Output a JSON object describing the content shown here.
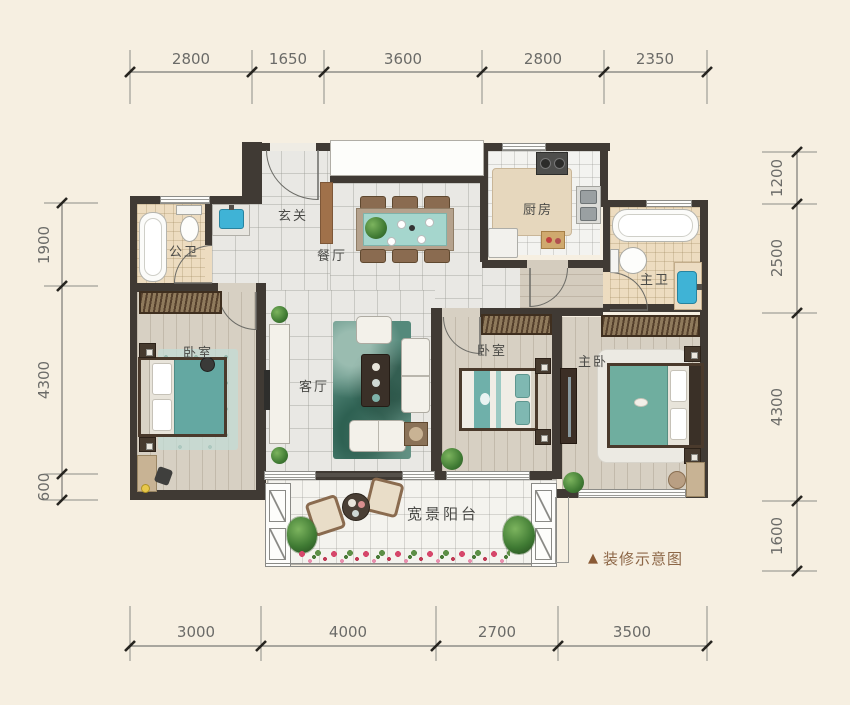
{
  "rooms": {
    "entry": "玄关",
    "guest_bath": "公卫",
    "dining": "餐厅",
    "kitchen": "厨房",
    "master_bath": "主卫",
    "bedroom_left": "卧室",
    "living": "客厅",
    "bedroom_middle": "卧室",
    "master_bedroom": "主卧",
    "balcony": "宽景阳台"
  },
  "legend": {
    "marker": "▲",
    "text": "装修示意图"
  },
  "dimensions": {
    "top": [
      "2800",
      "1650",
      "3600",
      "2800",
      "2350"
    ],
    "bottom": [
      "3000",
      "4000",
      "2700",
      "3500"
    ],
    "left": [
      "1900",
      "4300",
      "600"
    ],
    "right": [
      "1200",
      "2500",
      "4300",
      "1600"
    ]
  },
  "colors": {
    "background": "#f6efe1",
    "wall": "#403a34",
    "accent_teal": "#6fb0a8",
    "sink_blue": "#3fb3d6",
    "legend_brown": "#8d6747",
    "dimension_text": "#6b6b68"
  }
}
